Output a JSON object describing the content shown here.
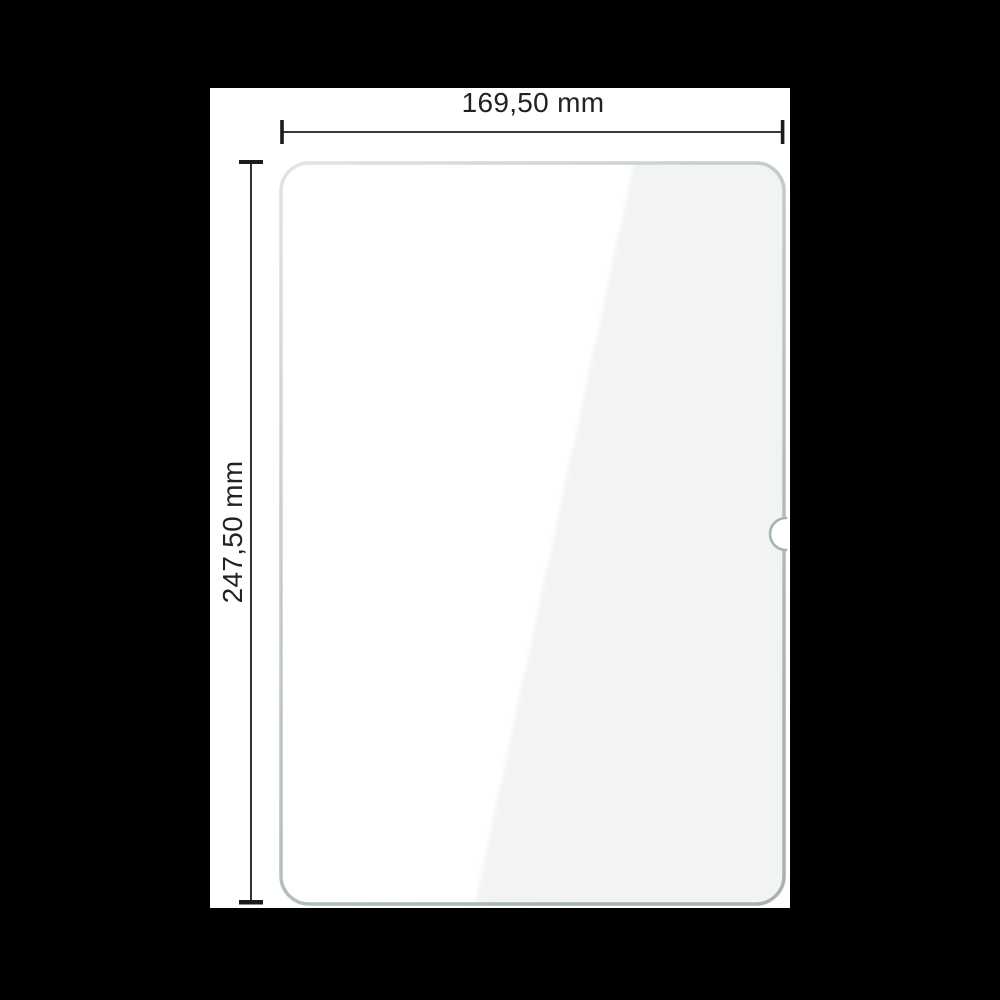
{
  "dimensions": {
    "width_label": "169,50 mm",
    "height_label": "247,50 mm"
  },
  "glass": {
    "shape": "rounded-rectangle",
    "notch": "camera-notch-right-edge-center",
    "reflection": "diagonal-sheen-right-side"
  },
  "colors": {
    "background": "#000000",
    "canvas": "#ffffff",
    "dimension_line": "#1c1c1c",
    "label_text": "#222222",
    "glass_fill": "#ffffff",
    "glass_reflection": "#f2f4f3",
    "glass_border_light": "#dfe5e2",
    "glass_border_mid": "#c2ccc8",
    "glass_border_dark": "#a7b3ae"
  }
}
